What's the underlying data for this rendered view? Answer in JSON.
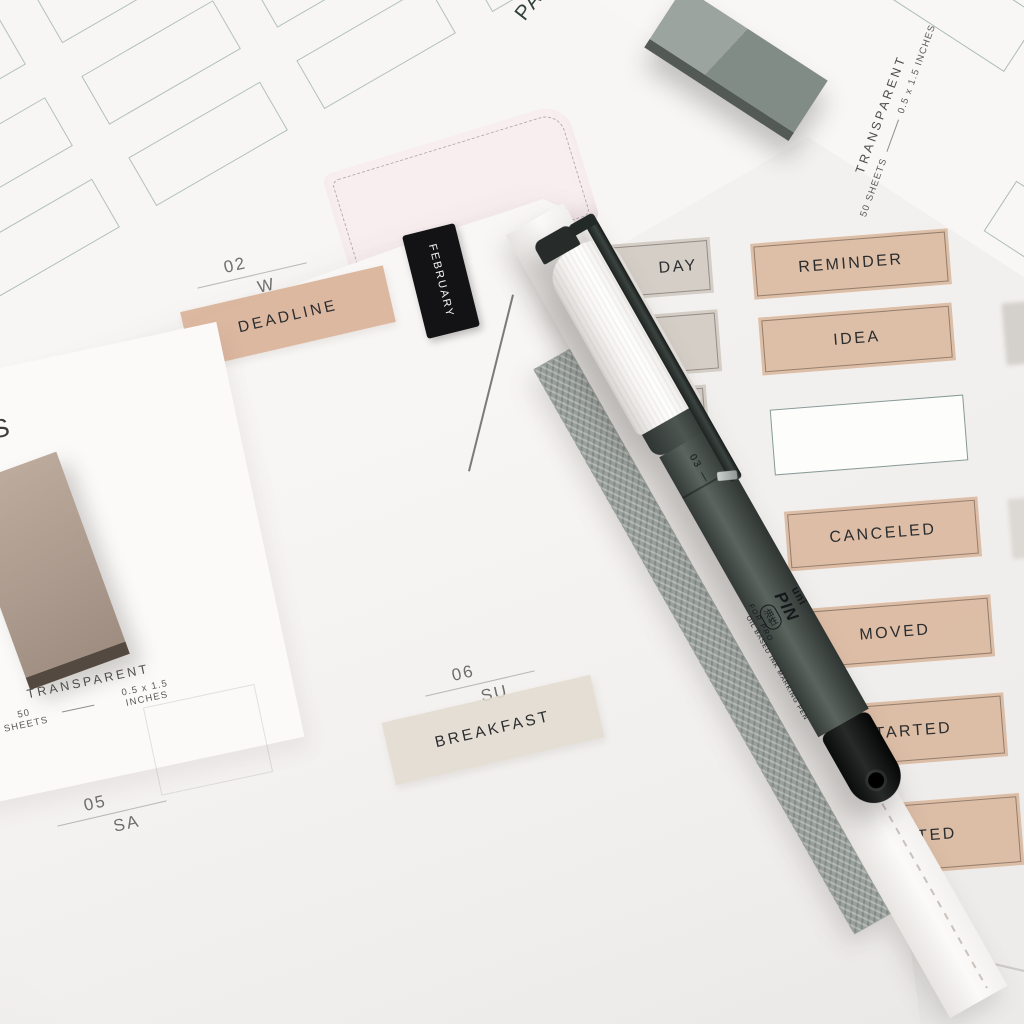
{
  "photo": {
    "planner": {
      "month_tab": "FEBRUARY",
      "date_markers": [
        {
          "day": "02",
          "weekday": "W"
        },
        {
          "day": "06",
          "weekday": "SU"
        },
        {
          "day": "05",
          "weekday": "SA"
        }
      ],
      "labels": [
        {
          "text": "DEADLINE"
        },
        {
          "text": "BREAKFAST"
        }
      ]
    },
    "left_card": {
      "partial_text": "GS",
      "pack": {
        "name": "TRANSPARENT",
        "count": "50 SHEETS",
        "size": "0.5 x 1.5 INCHES"
      }
    },
    "top_sheet": {
      "partial_title": "PA",
      "pack": {
        "name": "TRANSPARENT",
        "count": "50 SHEETS",
        "size": "0.5 x 1.5 INCHES"
      }
    },
    "sticker_sheet": {
      "gray_label_partial": "DAY",
      "tan_labels": [
        "REMINDER",
        "IDEA",
        "CANCELED",
        "MOVED",
        "STARTED"
      ],
      "tan_label_partial": "FTED"
    },
    "pen": {
      "brand": "uni",
      "model": "PIN",
      "jp_badge": "油性",
      "description": "OIL BASED INK MARKING PEN",
      "tagline": "FOR PRO",
      "nib_size": "03 —"
    },
    "colors": {
      "tan_label": "#d8b296",
      "gray_label": "#cfc8c1",
      "teal_outline": "#7a968f",
      "tab_black": "#131316",
      "pen_barrel": "#49524d",
      "cover_blush": "#f8eef0"
    }
  }
}
